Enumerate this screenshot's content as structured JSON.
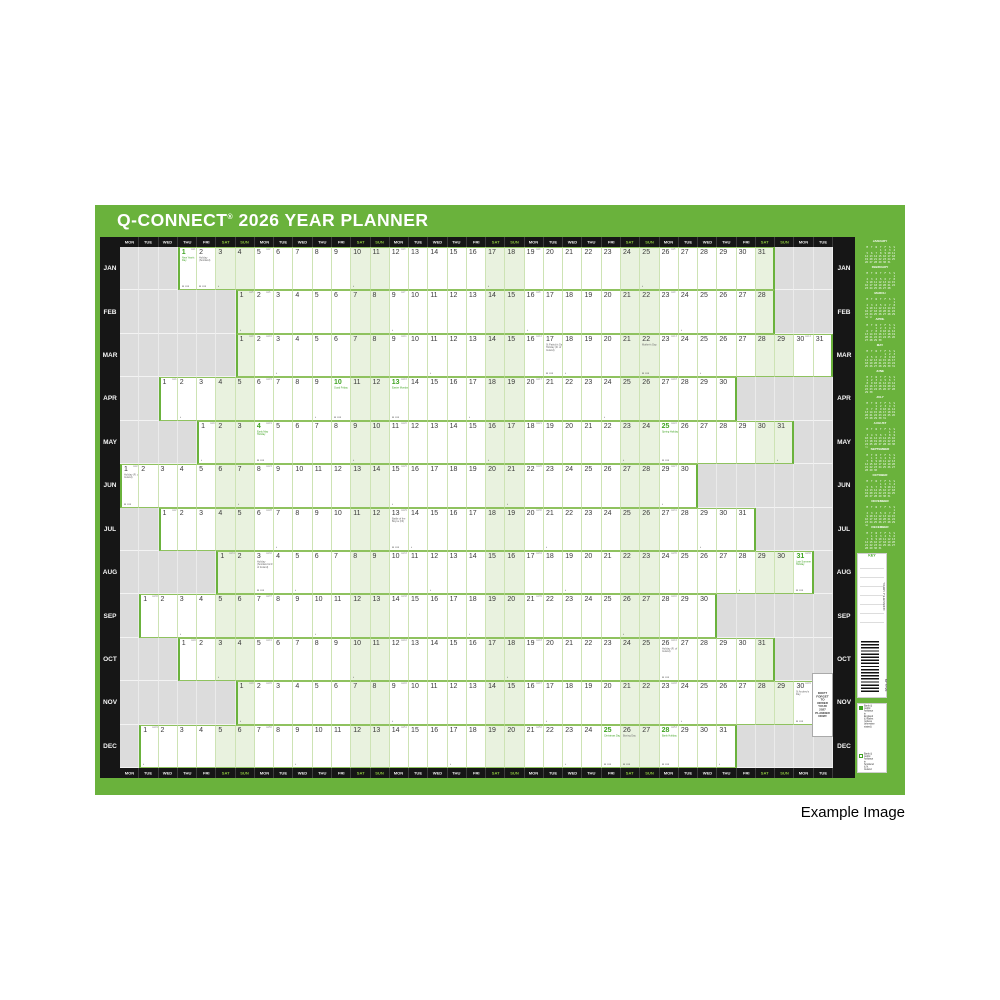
{
  "colors": {
    "green": "#6ab23c",
    "tint": "#e9f2df",
    "hdr-we": "#8dc63f",
    "holiday": "#3fa321",
    "black": "#161616"
  },
  "page": {
    "example_label": "Example Image"
  },
  "planner": {
    "title": {
      "brand": "Q-CONNECT",
      "reg": "®",
      "rest": "2026 YEAR PLANNER"
    },
    "day_cycle": [
      "MON",
      "TUE",
      "WED",
      "THU",
      "FRI",
      "SAT",
      "SUN"
    ],
    "columns": 37,
    "week_prefix": "wk",
    "moon_glyph": "▪",
    "cluster_glyph": "▪▪ ▪▪▪",
    "months": [
      {
        "label": "JAN",
        "start_col": 3,
        "days": 31,
        "holidays": [
          {
            "day": 1,
            "name": "New Year's Day",
            "green": true
          },
          {
            "day": 2,
            "name": "Holiday (Scotland)",
            "green": false
          }
        ],
        "moons": [
          3,
          10,
          17,
          25
        ]
      },
      {
        "label": "FEB",
        "start_col": 6,
        "days": 28,
        "holidays": [],
        "moons": [
          1,
          9,
          16,
          24
        ]
      },
      {
        "label": "MAR",
        "start_col": 6,
        "days": 31,
        "holidays": [
          {
            "day": 17,
            "name": "St Patrick's Day Holiday (R. of Ireland)",
            "green": false
          },
          {
            "day": 22,
            "name": "Mother's Day",
            "green": false
          }
        ],
        "moons": [
          3,
          11,
          18,
          25
        ]
      },
      {
        "label": "APR",
        "start_col": 2,
        "days": 30,
        "holidays": [
          {
            "day": 10,
            "name": "Good Friday",
            "green": true
          },
          {
            "day": 13,
            "name": "Easter Monday",
            "green": true
          }
        ],
        "moons": [
          2,
          9,
          17,
          24
        ]
      },
      {
        "label": "MAY",
        "start_col": 4,
        "days": 31,
        "holidays": [
          {
            "day": 4,
            "name": "Early May Holiday",
            "green": true
          },
          {
            "day": 25,
            "name": "Spring Holiday",
            "green": true
          }
        ],
        "moons": [
          1,
          9,
          16,
          23,
          31
        ]
      },
      {
        "label": "JUN",
        "start_col": 0,
        "days": 30,
        "holidays": [
          {
            "day": 1,
            "name": "Holiday (R. of Ireland)",
            "green": false
          }
        ],
        "moons": [
          7,
          15,
          21,
          29
        ]
      },
      {
        "label": "JUL",
        "start_col": 2,
        "days": 31,
        "holidays": [
          {
            "day": 13,
            "name": "Battle of the Boyne (NI)",
            "green": false
          }
        ],
        "moons": [
          7,
          14,
          21,
          29
        ]
      },
      {
        "label": "AUG",
        "start_col": 5,
        "days": 31,
        "holidays": [
          {
            "day": 3,
            "name": "Holiday (Scotland & R. of Ireland)",
            "green": false
          },
          {
            "day": 31,
            "name": "Late Summer Holiday",
            "green": true
          }
        ],
        "moons": [
          5,
          12,
          19,
          28
        ]
      },
      {
        "label": "SEP",
        "start_col": 1,
        "days": 30,
        "holidays": [],
        "moons": [
          3,
          10,
          18,
          26
        ]
      },
      {
        "label": "OCT",
        "start_col": 3,
        "days": 31,
        "holidays": [
          {
            "day": 26,
            "name": "Holiday (R. of Ireland)",
            "green": false
          }
        ],
        "moons": [
          3,
          10,
          18
        ]
      },
      {
        "label": "NOV",
        "start_col": 6,
        "days": 30,
        "holidays": [
          {
            "day": 30,
            "name": "St Andrew's Day",
            "green": false
          }
        ],
        "moons": [
          1,
          9,
          17,
          24
        ]
      },
      {
        "label": "DEC",
        "start_col": 1,
        "days": 31,
        "holidays": [
          {
            "day": 25,
            "name": "Christmas Day",
            "green": true
          },
          {
            "day": 26,
            "name": "Boxing Day",
            "green": false
          },
          {
            "day": 28,
            "name": "Bank Holiday",
            "green": true
          }
        ],
        "moons": [
          1,
          9,
          17,
          23,
          31
        ]
      }
    ],
    "side_month_names": [
      "JANUARY",
      "FEBRUARY",
      "MARCH",
      "APRIL",
      "MAY",
      "JUNE",
      "JULY",
      "AUGUST",
      "SEPTEMBER",
      "OCTOBER",
      "NOVEMBER",
      "DECEMBER"
    ],
    "mini_week_header": [
      "M",
      "T",
      "W",
      "T",
      "F",
      "S",
      "S"
    ],
    "key_panel": {
      "title": "KEY",
      "vertical_label": "YEAR PLANNER",
      "barcode_label": "KFYP26"
    },
    "legend": {
      "items": [
        {
          "swatch": "green",
          "text": "Bank & public holidays in England & Wales (unless otherwise stated)"
        },
        {
          "swatch": "green-outline",
          "text": "Bank & public holidays in Scotland & N. Ireland"
        },
        {
          "swatch": "black",
          "text": "Bank & public holidays in the Republic of Ireland"
        }
      ],
      "note": "All dates are believed correct at the time of going to print. The publisher cannot accept responsibility for any errors or omissions. Moon phases are shown in accordance with GMT."
    },
    "order_reminder": "DON'T FORGET TO ORDER YOUR 2027 PLANNER NOW!"
  }
}
